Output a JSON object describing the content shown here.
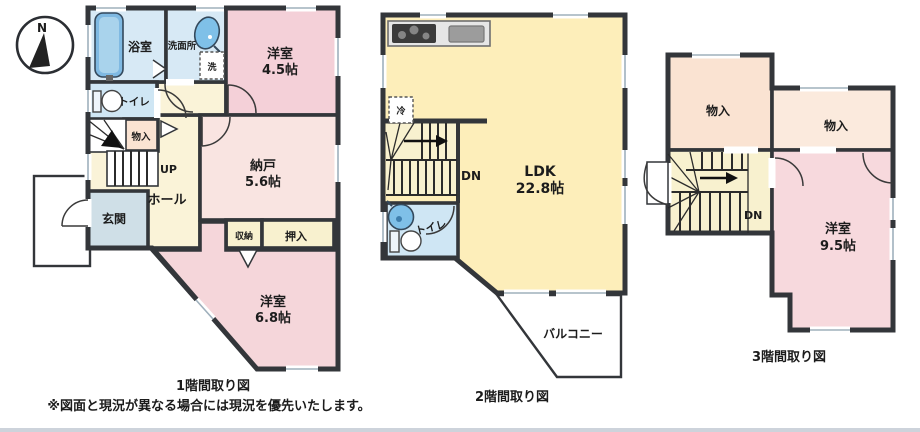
{
  "colors": {
    "wall": "#33363a",
    "water_blue": "#d7e9f5",
    "toilet_blue": "#cfe6f4",
    "pink_a": "#f4d0d8",
    "pink_b": "#f5d6da",
    "pink_c": "#f7d9dd",
    "pink_light": "#f9e4e1",
    "peach": "#fae3d2",
    "peach_light": "#fbeadd",
    "cream": "#faf3d8",
    "cream2": "#f8f1cf",
    "yellow": "#fdeeba",
    "entrance_gray": "#cfdfe7",
    "white": "#ffffff",
    "counter": "#e6e6e6",
    "stove": "#3b3b3b",
    "steel": "#9c9c9c",
    "tub": "#7fb9e2",
    "fixture_blue": "#7fc0e8"
  },
  "compass": {
    "north": "N"
  },
  "floor1": {
    "caption": "1階間取り図",
    "rooms": {
      "bathroom": {
        "label": "浴室"
      },
      "washroom": {
        "label": "洗面所"
      },
      "washer": {
        "label": "洗"
      },
      "western_a": {
        "label": "洋室",
        "size": "4.5帖"
      },
      "toilet": {
        "label": "トイレ"
      },
      "storage": {
        "label": "物入"
      },
      "stairs": {
        "label": "UP"
      },
      "storeroom": {
        "label": "納戸",
        "size": "5.6帖"
      },
      "hall": {
        "label": "ホール"
      },
      "entrance": {
        "label": "玄関"
      },
      "closet_a": {
        "label": "収納"
      },
      "closet_b": {
        "label": "押入"
      },
      "western_b": {
        "label": "洋室",
        "size": "6.8帖"
      }
    }
  },
  "floor2": {
    "caption": "2階間取り図",
    "rooms": {
      "ldk": {
        "label": "LDK",
        "size": "22.8帖"
      },
      "fridge": {
        "label": "冷"
      },
      "stairs": {
        "label": "DN"
      },
      "toilet": {
        "label": "トイレ"
      },
      "balcony": {
        "label": "バルコニー"
      }
    }
  },
  "floor3": {
    "caption": "3階間取り図",
    "rooms": {
      "storage_a": {
        "label": "物入"
      },
      "storage_b": {
        "label": "物入"
      },
      "stairs": {
        "label": "DN"
      },
      "western": {
        "label": "洋室",
        "size": "9.5帖"
      }
    }
  },
  "disclaimer": "※図面と現況が異なる場合には現況を優先いたします。"
}
